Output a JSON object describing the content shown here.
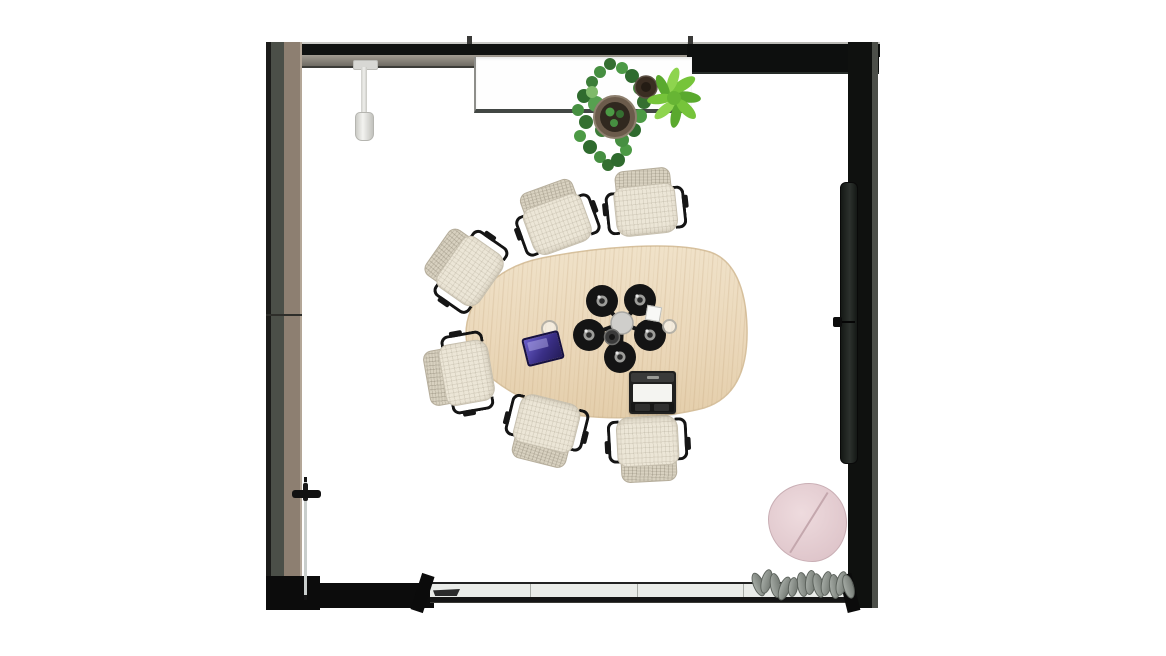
{
  "meta": {
    "view": "Top-down floor plan render",
    "room_type": "Meeting room"
  },
  "palette": {
    "floor": "#ffffff",
    "wall_dark": "#101211",
    "wall_taupe": "#8d7f71",
    "wall_grey_band": "#8a867e",
    "glass": "#eaece9",
    "table_wood": "#ead7ba",
    "chair_fabric": "#ece6d7",
    "chair_back": "#d8d1c0",
    "chair_frame": "#141414",
    "lamp_black": "#161616",
    "hub_grey": "#cfcecb",
    "pothos_green": "#3f8a3c",
    "fern_green": "#76c43a",
    "pot_brown": "#4a3a2c",
    "pouf_pink": "#e5ccd1",
    "tablet_purple": "#4a3d9e",
    "curtain_grey": "#8b918c",
    "dispenser_white": "#e9e9e6"
  },
  "inventory": {
    "table": {
      "label": "organic wood meeting table",
      "count": 1
    },
    "chairs": {
      "label": "upholstered office chair",
      "count": 6
    },
    "pendant_cluster": {
      "label": "pendant lamp cluster",
      "shade_count": 5
    },
    "laptop": {
      "label": "open laptop",
      "count": 1
    },
    "tablet": {
      "label": "tablet",
      "count": 1
    },
    "cups": {
      "label": "cup",
      "count": 2
    },
    "note": {
      "label": "small note pad",
      "count": 1
    },
    "plants": {
      "label": "potted plant on sideboard",
      "count": 2
    },
    "sideboard": {
      "label": "sideboard shelf",
      "count": 1
    },
    "pouf": {
      "label": "round pink pouf",
      "count": 1
    },
    "curtain": {
      "label": "gathered grey curtain",
      "count": 1
    },
    "door": {
      "label": "glass door with handle",
      "count": 1
    },
    "wall_panel": {
      "label": "wall-mounted screen panel",
      "count": 1
    },
    "dispenser": {
      "label": "wall-hung dispenser",
      "count": 1
    }
  }
}
